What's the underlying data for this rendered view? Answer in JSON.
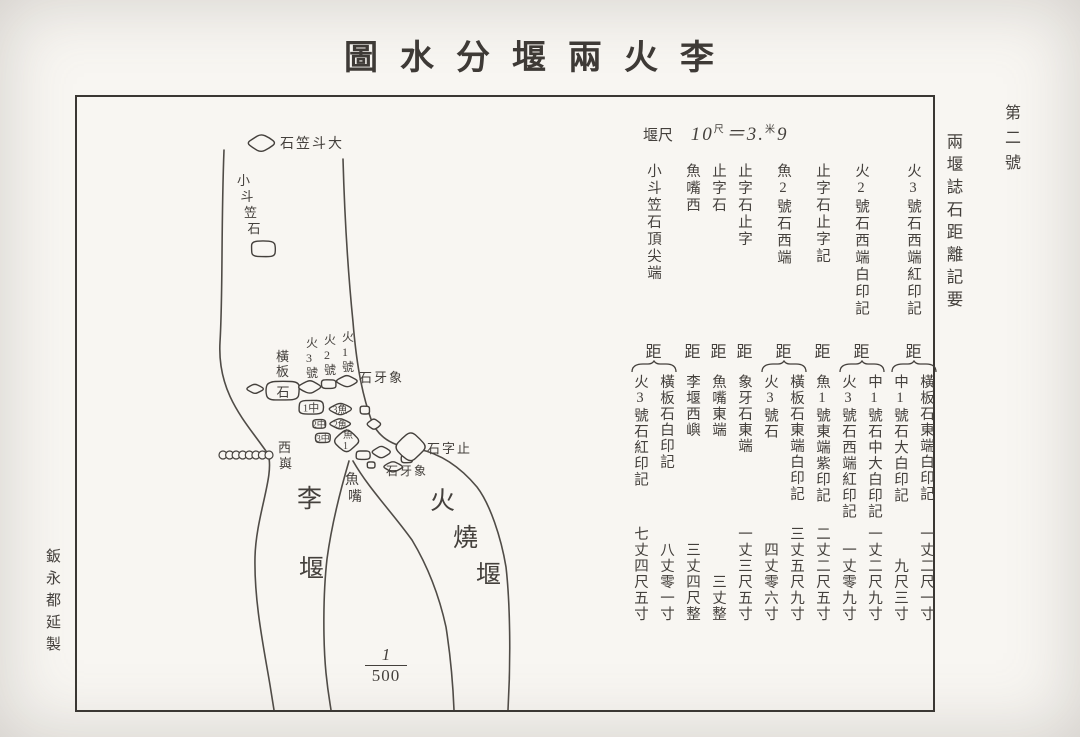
{
  "title": "李火兩堰分水圖",
  "margins": {
    "sheet_number": "第二號",
    "right_title": "兩堰誌石距離記要",
    "left_credit": "鈑永都延製"
  },
  "scale_note": {
    "label": "堰尺",
    "base": "10",
    "base_unit": "尺",
    "equals": "＝",
    "result_int": "3",
    "result_unit": "米",
    "result_dec": "9"
  },
  "distance_label": "距",
  "records": [
    {
      "header": "火3號石西端紅印記",
      "items": [
        {
          "name": "橫板石東端白印記",
          "value": "一丈二尺一寸"
        },
        {
          "name": "中1號石大白印記",
          "value": "九尺三寸"
        }
      ]
    },
    {
      "header": "火2號石西端白印記",
      "items": [
        {
          "name": "中1號石中大白印記",
          "value": "一丈二尺九寸"
        },
        {
          "name": "火3號石西端紅印記",
          "value": "一丈零九寸"
        }
      ]
    },
    {
      "header": "止字石止字記",
      "items": [
        {
          "name": "魚1號東端紫印記",
          "value": "二丈二尺五寸"
        }
      ]
    },
    {
      "header": "魚2號石西端",
      "items": [
        {
          "name": "橫板石東端白印記",
          "value": "三丈五尺九寸"
        },
        {
          "name": "火3號石",
          "value": "四丈零六寸"
        }
      ]
    },
    {
      "header": "止字石止字",
      "items": [
        {
          "name": "象牙石東端",
          "value": "一丈三尺五寸"
        }
      ]
    },
    {
      "header": "止字石",
      "items": [
        {
          "name": "魚嘴東端",
          "value": "三丈整"
        }
      ]
    },
    {
      "header": "魚嘴西",
      "items": [
        {
          "name": "李堰西嶼",
          "value": "三丈四尺整"
        }
      ]
    },
    {
      "header": "小斗笠石頂尖端",
      "items": [
        {
          "name": "橫板石白印記",
          "value": "八丈零一寸"
        },
        {
          "name": "火3號石紅印記",
          "value": "七丈四尺五寸"
        }
      ]
    }
  ],
  "map": {
    "scale_fraction": {
      "numerator": "1",
      "denominator": "500"
    },
    "labels": [
      {
        "id": "da-douli-shi",
        "text": "大斗笠石",
        "mode": "h-rtl",
        "x": 203,
        "y": 51,
        "size": 14
      },
      {
        "id": "xiao-douli-shi",
        "text": "小斗笠石",
        "mode": "v",
        "x": 160,
        "y": 88,
        "size": 13,
        "spacing": 16,
        "dx": 3.5
      },
      {
        "id": "hengban-shi",
        "text": "橫板",
        "mode": "v",
        "x": 199,
        "y": 264,
        "size": 13,
        "spacing": 15,
        "dx": 0
      },
      {
        "id": "huo-3-hao",
        "text": "火3號",
        "mode": "v",
        "x": 229,
        "y": 250,
        "size": 12,
        "spacing": 15,
        "dx": 0
      },
      {
        "id": "huo-2-hao",
        "text": "火2號",
        "mode": "v",
        "x": 247,
        "y": 247,
        "size": 12,
        "spacing": 15,
        "dx": 0
      },
      {
        "id": "huo-1-hao",
        "text": "火1號",
        "mode": "v",
        "x": 265,
        "y": 244,
        "size": 12,
        "spacing": 15,
        "dx": 0
      },
      {
        "id": "xiangya-shi-upper",
        "text": "象牙石",
        "mode": "h-rtl",
        "x": 282,
        "y": 285,
        "size": 13
      },
      {
        "id": "xi-yu",
        "text": "西㠘",
        "mode": "v",
        "x": 201,
        "y": 355,
        "size": 13,
        "spacing": 16,
        "dx": 1
      },
      {
        "id": "zhizi-shi",
        "text": "止字石",
        "mode": "h-rtl",
        "x": 350,
        "y": 356,
        "size": 13
      },
      {
        "id": "xiangya-shi-lower",
        "text": "象牙石",
        "mode": "h-rtl",
        "x": 309,
        "y": 378,
        "size": 12
      },
      {
        "id": "yu-zui",
        "text": "魚嘴",
        "mode": "v",
        "x": 268,
        "y": 387,
        "size": 14,
        "spacing": 17,
        "dx": 3
      },
      {
        "id": "li-yan",
        "text": "李堰",
        "mode": "v",
        "x": 220,
        "y": 410,
        "size": 25,
        "spacing": 70,
        "dx": 2
      },
      {
        "id": "huoshao-yan",
        "text": "火燒堰",
        "mode": "v",
        "x": 353,
        "y": 412,
        "size": 25,
        "spacing": 37,
        "dx": 23
      }
    ],
    "stones": [
      {
        "id": "rock-da-douli",
        "cx": 184,
        "cy": 46,
        "w": 26,
        "h": 16
      },
      {
        "id": "rock-xiao-douli",
        "cx": 186,
        "cy": 152,
        "w": 28,
        "h": 18
      },
      {
        "id": "rock-hengban-west",
        "cx": 178,
        "cy": 292,
        "w": 16,
        "h": 9
      },
      {
        "id": "rock-hengban",
        "cx": 206,
        "cy": 294,
        "w": 38,
        "h": 22,
        "label": "石",
        "lmode": "c",
        "lsize": 13
      },
      {
        "id": "rock-huo3",
        "cx": 233,
        "cy": 290,
        "w": 22,
        "h": 12
      },
      {
        "id": "rock-huo2",
        "cx": 252,
        "cy": 287,
        "w": 17,
        "h": 10
      },
      {
        "id": "rock-huo1",
        "cx": 270,
        "cy": 284,
        "w": 20,
        "h": 11
      },
      {
        "id": "rock-zhong1",
        "cx": 234,
        "cy": 310,
        "w": 28,
        "h": 16,
        "label": "中1",
        "lmode": "h-rtl",
        "lsize": 11
      },
      {
        "id": "rock-yu3",
        "cx": 263,
        "cy": 312,
        "w": 22,
        "h": 11,
        "label": "魚3",
        "lmode": "h-rtl",
        "lsize": 10
      },
      {
        "id": "rock-zhong2",
        "cx": 242,
        "cy": 327,
        "w": 15,
        "h": 10,
        "label": "中2",
        "lmode": "h-rtl",
        "lsize": 9
      },
      {
        "id": "rock-yu2",
        "cx": 263,
        "cy": 327,
        "w": 20,
        "h": 10,
        "label": "魚2",
        "lmode": "h-rtl",
        "lsize": 9
      },
      {
        "id": "rock-zhong3",
        "cx": 246,
        "cy": 341,
        "w": 17,
        "h": 11,
        "label": "中3",
        "lmode": "h-rtl",
        "lsize": 9
      },
      {
        "id": "rock-yu1",
        "cx": 270,
        "cy": 344,
        "w": 24,
        "h": 21,
        "label": "魚1",
        "lmode": "v",
        "lsize": 10
      },
      {
        "id": "rock-small-a",
        "cx": 288,
        "cy": 313,
        "w": 11,
        "h": 9
      },
      {
        "id": "rock-small-b",
        "cx": 297,
        "cy": 327,
        "w": 13,
        "h": 10
      },
      {
        "id": "rock-fm-a",
        "cx": 286,
        "cy": 358,
        "w": 16,
        "h": 10
      },
      {
        "id": "rock-fm-b",
        "cx": 304,
        "cy": 355,
        "w": 18,
        "h": 11
      },
      {
        "id": "rock-fm-c",
        "cx": 294,
        "cy": 368,
        "w": 9,
        "h": 7
      },
      {
        "id": "rock-fm-d",
        "cx": 316,
        "cy": 370,
        "w": 18,
        "h": 10
      },
      {
        "id": "rock-fm-e",
        "cx": 330,
        "cy": 362,
        "w": 13,
        "h": 9
      },
      {
        "id": "rock-zhizi",
        "cx": 334,
        "cy": 350,
        "w": 29,
        "h": 27
      }
    ],
    "islet_chain": {
      "count": 8,
      "x_start": 146,
      "x_end": 192,
      "cy": 358,
      "r": 4
    }
  }
}
